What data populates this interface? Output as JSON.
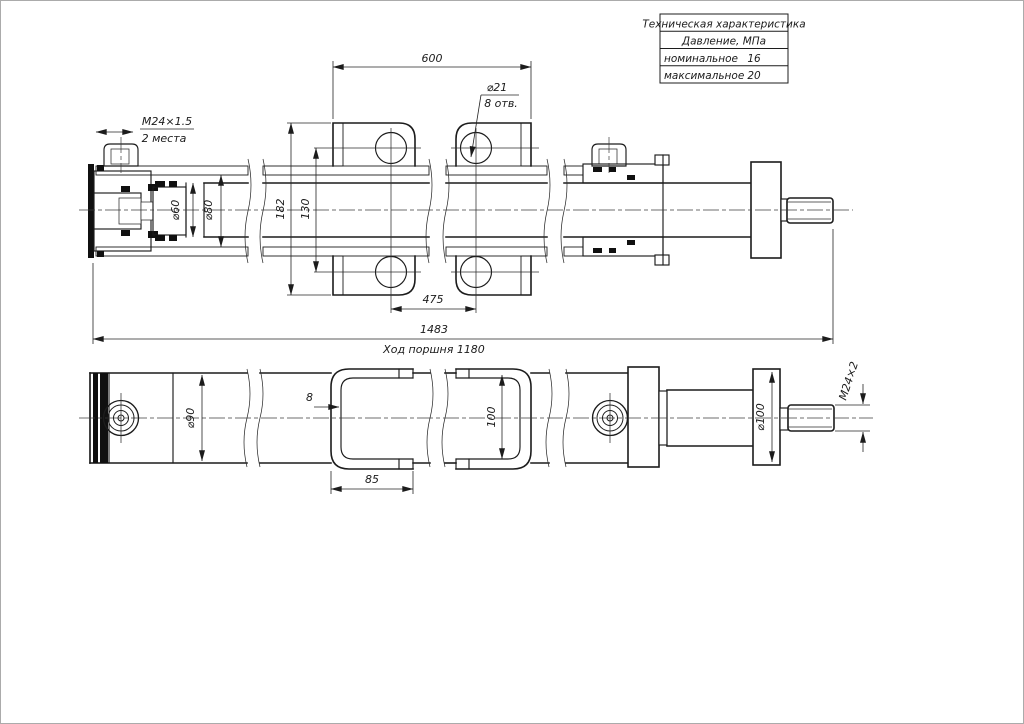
{
  "drawing": {
    "background": "#ffffff",
    "line_color": "#1c1c1c"
  },
  "spec_table": {
    "title": "Техническая характеристика",
    "subtitle": "Давление, МПа",
    "rows": [
      {
        "label": "номинальное",
        "value": "16"
      },
      {
        "label": "максимальное",
        "value": "20"
      }
    ]
  },
  "section_view": {
    "dim_brackets_span": "600",
    "hole_dia": "⌀21",
    "hole_count": "8 отв.",
    "port_thread": "M24×1.5",
    "port_places": "2 места",
    "rod_dia": "⌀60",
    "bore_dia": "⌀80",
    "dim_outer_height": "182",
    "dim_hole_centers": "130",
    "dim_hole_spacing": "475",
    "dim_overall": "1483",
    "stroke_note": "Ход поршня 1180"
  },
  "plan_view": {
    "tube_dia": "⌀90",
    "bracket_wall": "8",
    "bracket_width": "85",
    "bracket_height": "100",
    "flange_dia": "⌀100",
    "rod_thread": "M24×2"
  }
}
